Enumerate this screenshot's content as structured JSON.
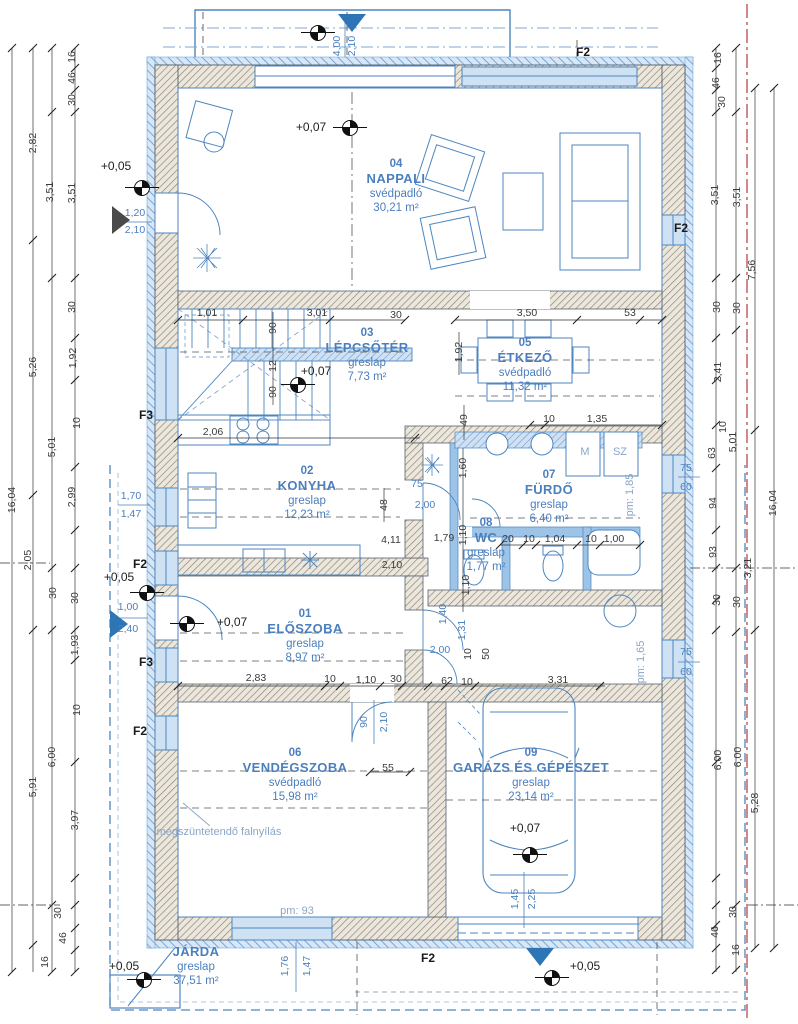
{
  "colors": {
    "line_blue": "#4d86c0",
    "light_blue": "#9dc3e6",
    "label_blue": "#4b7fbe",
    "dim_black": "#3a3a3a",
    "boundary_red": "#b23b3b",
    "wall_fill": "#eae5db"
  },
  "rooms": [
    {
      "number": "04",
      "name": "NAPPALI",
      "floor": "svédpadló",
      "area": "30,21 m²",
      "cx": 396,
      "top": 157
    },
    {
      "number": "03",
      "name": "LÉPCSŐTÉR",
      "floor": "greslap",
      "area": "7,73 m²",
      "cx": 367,
      "top": 326
    },
    {
      "number": "05",
      "name": "ÉTKEZŐ",
      "floor": "svédpadló",
      "area": "11,32 m²",
      "cx": 525,
      "top": 336
    },
    {
      "number": "02",
      "name": "KONYHA",
      "floor": "greslap",
      "area": "12,23 m²",
      "cx": 307,
      "top": 464
    },
    {
      "number": "07",
      "name": "FÜRDŐ",
      "floor": "greslap",
      "area": "6,40 m²",
      "cx": 549,
      "top": 468
    },
    {
      "number": "08",
      "name": "WC",
      "floor": "greslap",
      "area": "1,77 m²",
      "cx": 486,
      "top": 516
    },
    {
      "number": "01",
      "name": "ELŐSZOBA",
      "floor": "greslap",
      "area": "8,97 m²",
      "cx": 305,
      "top": 607
    },
    {
      "number": "06",
      "name": "VENDÉGSZOBA",
      "floor": "svédpadló",
      "area": "15,98 m²",
      "cx": 295,
      "top": 746
    },
    {
      "number": "09",
      "name": "GARÁZS ÉS GÉPÉSZET",
      "floor": "greslap",
      "area": "23,14 m²",
      "cx": 531,
      "top": 746
    },
    {
      "number": "",
      "name": "JÁRDA",
      "floor": "greslap",
      "area": "37,51 m²",
      "cx": 196,
      "top": 944
    }
  ],
  "levels": [
    {
      "t": "+0,07",
      "x": 311,
      "y": 127,
      "sx": 349,
      "sy": 127
    },
    {
      "t": "+0,05",
      "x": 116,
      "y": 166,
      "sx": 141,
      "sy": 187
    },
    {
      "t": "+0,07",
      "x": 316,
      "y": 371,
      "sx": 297,
      "sy": 384
    },
    {
      "t": "+0,05",
      "x": 119,
      "y": 577,
      "sx": 146,
      "sy": 592
    },
    {
      "t": "+0,07",
      "x": 232,
      "y": 622,
      "sx": 186,
      "sy": 623
    },
    {
      "t": "+0,07",
      "x": 525,
      "y": 828,
      "sx": 529,
      "sy": 854
    },
    {
      "t": "+0,05",
      "x": 124,
      "y": 966,
      "sx": 143,
      "sy": 979
    },
    {
      "t": "+0,05",
      "x": 585,
      "y": 966,
      "sx": 551,
      "sy": 977
    },
    {
      "t": "",
      "x": 0,
      "y": 0,
      "sx": 317,
      "sy": 32
    }
  ],
  "window_marks": [
    {
      "t": "F2",
      "x": 583,
      "y": 52
    },
    {
      "t": "F2",
      "x": 681,
      "y": 228
    },
    {
      "t": "F3",
      "x": 146,
      "y": 415
    },
    {
      "t": "F2",
      "x": 140,
      "y": 564
    },
    {
      "t": "F3",
      "x": 146,
      "y": 662
    },
    {
      "t": "F2",
      "x": 140,
      "y": 731
    },
    {
      "t": "F2",
      "x": 428,
      "y": 958
    }
  ],
  "dims_black": [
    {
      "x": 207,
      "y": 313,
      "t": "1,01"
    },
    {
      "x": 317,
      "y": 313,
      "t": "3,01"
    },
    {
      "x": 396,
      "y": 315,
      "t": "30"
    },
    {
      "x": 527,
      "y": 313,
      "t": "3,50"
    },
    {
      "x": 630,
      "y": 313,
      "t": "53"
    },
    {
      "x": 273,
      "y": 328,
      "t": "90",
      "v": 1
    },
    {
      "x": 273,
      "y": 366,
      "t": "12",
      "v": 1
    },
    {
      "x": 273,
      "y": 392,
      "t": "90",
      "v": 1
    },
    {
      "x": 459,
      "y": 352,
      "t": "1,92",
      "v": 1
    },
    {
      "x": 464,
      "y": 420,
      "t": "49",
      "v": 1
    },
    {
      "x": 213,
      "y": 432,
      "t": "2,06"
    },
    {
      "x": 549,
      "y": 419,
      "t": "10"
    },
    {
      "x": 597,
      "y": 419,
      "t": "1,35"
    },
    {
      "x": 384,
      "y": 505,
      "t": "48",
      "v": 1
    },
    {
      "x": 463,
      "y": 468,
      "t": "1,60",
      "v": 1
    },
    {
      "x": 463,
      "y": 535,
      "t": "1,10",
      "v": 1
    },
    {
      "x": 466,
      "y": 585,
      "t": "1,10",
      "v": 1
    },
    {
      "x": 391,
      "y": 540,
      "t": "4,11"
    },
    {
      "x": 444,
      "y": 538,
      "t": "1,79"
    },
    {
      "x": 392,
      "y": 565,
      "t": "2,10"
    },
    {
      "x": 508,
      "y": 539,
      "t": "20"
    },
    {
      "x": 529,
      "y": 539,
      "t": "10"
    },
    {
      "x": 555,
      "y": 539,
      "t": "1,04"
    },
    {
      "x": 591,
      "y": 539,
      "t": "10"
    },
    {
      "x": 614,
      "y": 539,
      "t": "1,00"
    },
    {
      "x": 256,
      "y": 678,
      "t": "2,83"
    },
    {
      "x": 330,
      "y": 679,
      "t": "10"
    },
    {
      "x": 366,
      "y": 680,
      "t": "1,10"
    },
    {
      "x": 396,
      "y": 679,
      "t": "30"
    },
    {
      "x": 447,
      "y": 681,
      "t": "62"
    },
    {
      "x": 467,
      "y": 682,
      "t": "10"
    },
    {
      "x": 558,
      "y": 680,
      "t": "3,31"
    },
    {
      "x": 468,
      "y": 654,
      "t": "10",
      "v": 1
    },
    {
      "x": 486,
      "y": 654,
      "t": "50",
      "v": 1
    },
    {
      "x": 388,
      "y": 768,
      "t": "55"
    },
    {
      "x": 12,
      "y": 500,
      "t": "16,04",
      "v": 1
    },
    {
      "x": 33,
      "y": 143,
      "t": "2,82",
      "v": 1
    },
    {
      "x": 33,
      "y": 367,
      "t": "5,26",
      "v": 1
    },
    {
      "x": 28,
      "y": 560,
      "t": "2,05",
      "v": 1
    },
    {
      "x": 33,
      "y": 787,
      "t": "5,91",
      "v": 1
    },
    {
      "x": 50,
      "y": 192,
      "t": "3,51",
      "v": 1
    },
    {
      "x": 52,
      "y": 447,
      "t": "5,01",
      "v": 1
    },
    {
      "x": 53,
      "y": 593,
      "t": "30",
      "v": 1
    },
    {
      "x": 52,
      "y": 757,
      "t": "6,00",
      "v": 1
    },
    {
      "x": 72,
      "y": 57,
      "t": "16",
      "v": 1
    },
    {
      "x": 72,
      "y": 78,
      "t": "46",
      "v": 1
    },
    {
      "x": 72,
      "y": 100,
      "t": "30",
      "v": 1
    },
    {
      "x": 72,
      "y": 193,
      "t": "3,51",
      "v": 1
    },
    {
      "x": 72,
      "y": 307,
      "t": "30",
      "v": 1
    },
    {
      "x": 73,
      "y": 358,
      "t": "1,92",
      "v": 1
    },
    {
      "x": 77,
      "y": 423,
      "t": "10",
      "v": 1
    },
    {
      "x": 72,
      "y": 497,
      "t": "2,99",
      "v": 1
    },
    {
      "x": 75,
      "y": 598,
      "t": "30",
      "v": 1
    },
    {
      "x": 75,
      "y": 645,
      "t": "1,93",
      "v": 1
    },
    {
      "x": 77,
      "y": 710,
      "t": "10",
      "v": 1
    },
    {
      "x": 75,
      "y": 820,
      "t": "3,97",
      "v": 1
    },
    {
      "x": 58,
      "y": 913,
      "t": "30",
      "v": 1
    },
    {
      "x": 63,
      "y": 938,
      "t": "46",
      "v": 1
    },
    {
      "x": 45,
      "y": 962,
      "t": "16",
      "v": 1
    },
    {
      "x": 718,
      "y": 58,
      "t": "16",
      "v": 1
    },
    {
      "x": 716,
      "y": 83,
      "t": "46",
      "v": 1
    },
    {
      "x": 722,
      "y": 102,
      "t": "30",
      "v": 1
    },
    {
      "x": 715,
      "y": 195,
      "t": "3,51",
      "v": 1
    },
    {
      "x": 737,
      "y": 197,
      "t": "3,51",
      "v": 1
    },
    {
      "x": 752,
      "y": 270,
      "t": "7,56",
      "v": 1
    },
    {
      "x": 717,
      "y": 307,
      "t": "30",
      "v": 1
    },
    {
      "x": 737,
      "y": 308,
      "t": "30",
      "v": 1
    },
    {
      "x": 718,
      "y": 372,
      "t": "2,41",
      "v": 1
    },
    {
      "x": 723,
      "y": 427,
      "t": "10",
      "v": 1
    },
    {
      "x": 712,
      "y": 453,
      "t": "63",
      "v": 1
    },
    {
      "x": 733,
      "y": 442,
      "t": "5,01",
      "v": 1
    },
    {
      "x": 713,
      "y": 503,
      "t": "94",
      "v": 1
    },
    {
      "x": 773,
      "y": 503,
      "t": "16,04",
      "v": 1
    },
    {
      "x": 713,
      "y": 552,
      "t": "93",
      "v": 1
    },
    {
      "x": 748,
      "y": 568,
      "t": "3,21",
      "v": 1
    },
    {
      "x": 717,
      "y": 600,
      "t": "30",
      "v": 1
    },
    {
      "x": 737,
      "y": 602,
      "t": "30",
      "v": 1
    },
    {
      "x": 718,
      "y": 760,
      "t": "6,00",
      "v": 1
    },
    {
      "x": 738,
      "y": 757,
      "t": "6,00",
      "v": 1
    },
    {
      "x": 755,
      "y": 803,
      "t": "5,28",
      "v": 1
    },
    {
      "x": 733,
      "y": 912,
      "t": "30",
      "v": 1
    },
    {
      "x": 715,
      "y": 932,
      "t": "46",
      "v": 1
    },
    {
      "x": 736,
      "y": 950,
      "t": "16",
      "v": 1
    }
  ],
  "dims_blue": [
    {
      "x": 135,
      "y": 213,
      "t": "1,20"
    },
    {
      "x": 135,
      "y": 230,
      "t": "2,10"
    },
    {
      "x": 131,
      "y": 496,
      "t": "1,70"
    },
    {
      "x": 131,
      "y": 514,
      "t": "1,47"
    },
    {
      "x": 128,
      "y": 607,
      "t": "1,00"
    },
    {
      "x": 128,
      "y": 629,
      "t": "2,40"
    },
    {
      "x": 337,
      "y": 46,
      "t": "4,00",
      "v": 1
    },
    {
      "x": 352,
      "y": 46,
      "t": "2,10",
      "v": 1
    },
    {
      "x": 686,
      "y": 468,
      "t": "75"
    },
    {
      "x": 686,
      "y": 487,
      "t": "60"
    },
    {
      "x": 686,
      "y": 652,
      "t": "75"
    },
    {
      "x": 686,
      "y": 672,
      "t": "60"
    },
    {
      "x": 417,
      "y": 484,
      "t": "75"
    },
    {
      "x": 425,
      "y": 505,
      "t": "2,00"
    },
    {
      "x": 364,
      "y": 722,
      "t": "90",
      "v": 1
    },
    {
      "x": 384,
      "y": 722,
      "t": "2,10",
      "v": 1
    },
    {
      "x": 440,
      "y": 650,
      "t": "2,00"
    },
    {
      "x": 443,
      "y": 614,
      "t": "1,40",
      "v": 1
    },
    {
      "x": 462,
      "y": 630,
      "t": "1,31",
      "v": 1
    },
    {
      "x": 285,
      "y": 966,
      "t": "1,76",
      "v": 1
    },
    {
      "x": 307,
      "y": 966,
      "t": "1,47",
      "v": 1
    },
    {
      "x": 515,
      "y": 899,
      "t": "1,45",
      "v": 1
    },
    {
      "x": 532,
      "y": 899,
      "t": "2,25",
      "v": 1
    }
  ],
  "notes": [
    {
      "t": "megszüntetendő falnyílás",
      "x": 219,
      "y": 832
    },
    {
      "t": "pm: 93",
      "x": 297,
      "y": 911
    },
    {
      "t": "pm: 1,85",
      "x": 630,
      "y": 495,
      "v": 1
    },
    {
      "t": "pm: 1,65",
      "x": 641,
      "y": 662,
      "v": 1
    },
    {
      "t": "M",
      "x": 585,
      "y": 452
    },
    {
      "t": "SZ",
      "x": 620,
      "y": 452
    }
  ]
}
